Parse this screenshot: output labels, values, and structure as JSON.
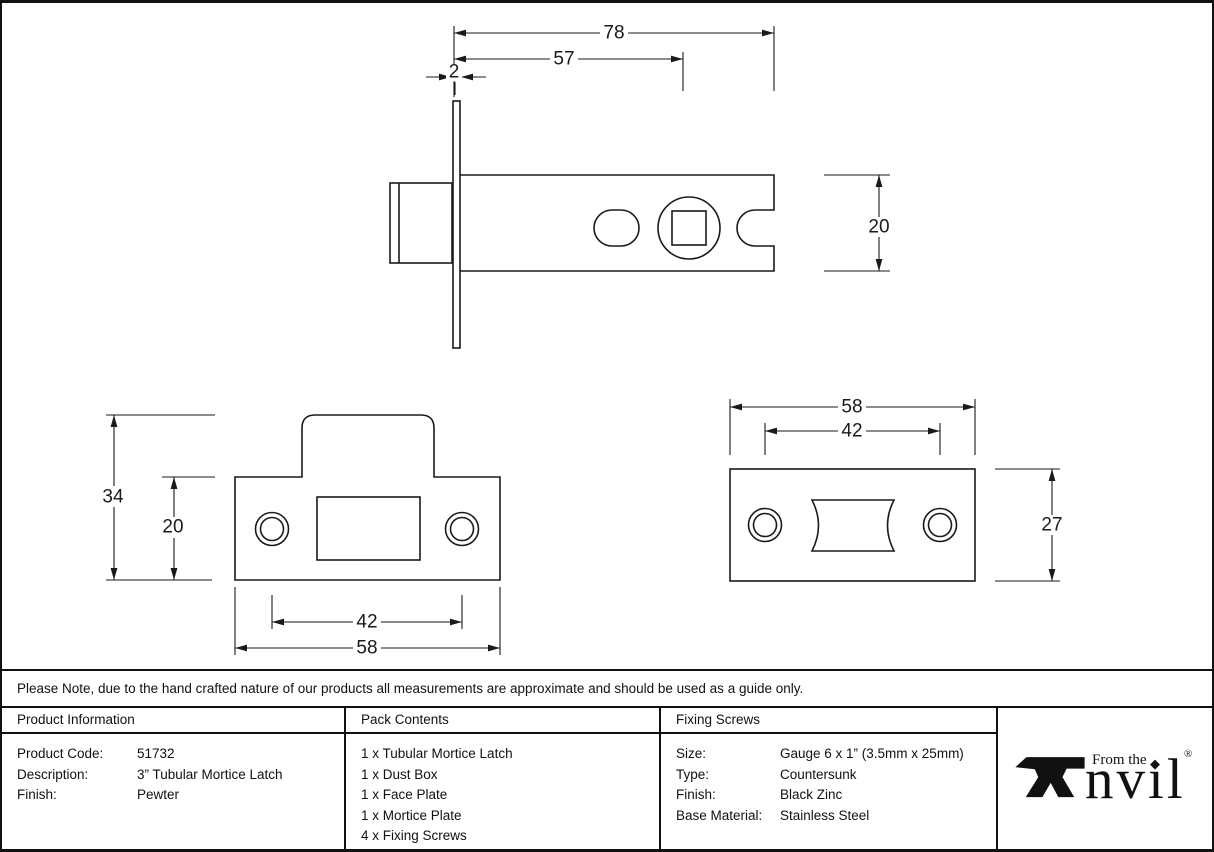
{
  "note": "Please Note, due to the hand crafted nature of our products all measurements are approximate and should be used as a guide only.",
  "drawings": {
    "side_view": {
      "overall_length": "78",
      "body_length": "57",
      "faceplate_thickness": "2",
      "body_height": "20"
    },
    "mortice_plate": {
      "overall_height": "34",
      "plate_height": "20",
      "screw_centres": "42",
      "plate_width": "58"
    },
    "face_plate": {
      "plate_width": "58",
      "screw_centres": "42",
      "plate_height": "27"
    }
  },
  "product_information": {
    "header": "Product Information",
    "rows": [
      {
        "label": "Product Code:",
        "value": "51732"
      },
      {
        "label": "Description:",
        "value": "3” Tubular Mortice Latch"
      },
      {
        "label": "Finish:",
        "value": "Pewter"
      }
    ]
  },
  "pack_contents": {
    "header": "Pack Contents",
    "items": [
      "1 x Tubular Mortice Latch",
      "1 x Dust Box",
      "1 x Face Plate",
      "1 x Mortice Plate",
      "4 x Fixing Screws"
    ]
  },
  "fixing_screws": {
    "header": "Fixing Screws",
    "rows": [
      {
        "label": "Size:",
        "value": "Gauge 6 x 1” (3.5mm x 25mm)"
      },
      {
        "label": "Type:",
        "value": "Countersunk"
      },
      {
        "label": "Finish:",
        "value": "Black Zinc"
      },
      {
        "label": "Base Material:",
        "value": "Stainless Steel"
      }
    ]
  },
  "logo": {
    "prefix": "From the",
    "wordmark": "nvıl",
    "tittle": "◆",
    "registered": "®"
  }
}
